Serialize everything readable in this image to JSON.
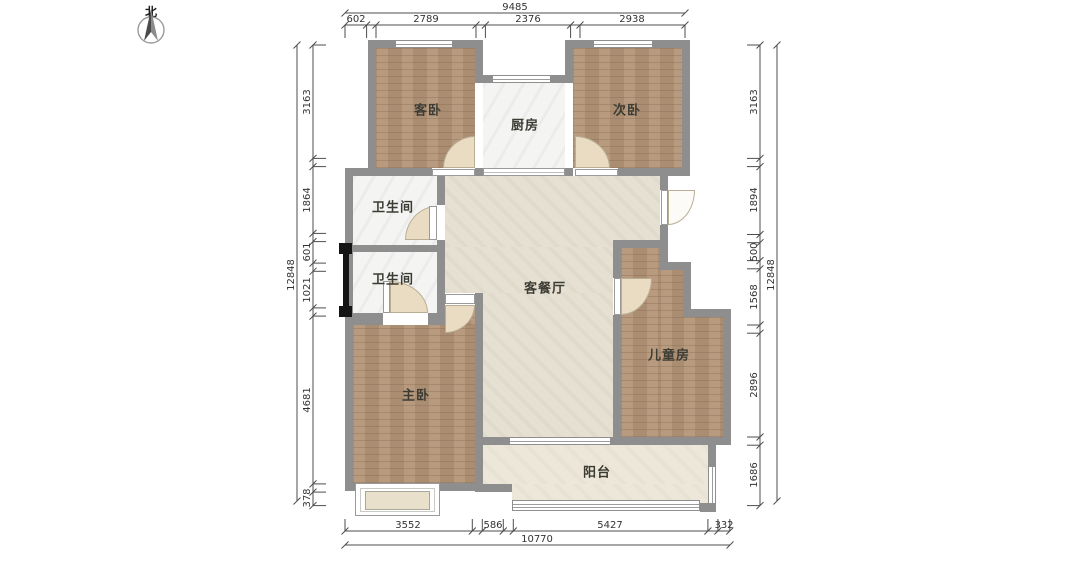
{
  "compass": {
    "label": "北"
  },
  "rooms": [
    {
      "name": "guest-bedroom",
      "label": "客卧"
    },
    {
      "name": "kitchen",
      "label": "厨房"
    },
    {
      "name": "second-bedroom",
      "label": "次卧"
    },
    {
      "name": "bathroom-upper",
      "label": "卫生间"
    },
    {
      "name": "bathroom-lower",
      "label": "卫生间"
    },
    {
      "name": "living-dining",
      "label": "客餐厅"
    },
    {
      "name": "master-bedroom",
      "label": "主卧"
    },
    {
      "name": "children-room",
      "label": "儿童房"
    },
    {
      "name": "balcony",
      "label": "阳台"
    }
  ],
  "dimensions": {
    "top": {
      "total": "9485",
      "segments": [
        "602",
        "2789",
        "2376",
        "2938"
      ]
    },
    "bottom": {
      "total": "10770",
      "segments": [
        "3552",
        "586",
        "5427",
        "332"
      ]
    },
    "left": {
      "total": "12848",
      "segments": [
        "3163",
        "1864",
        "601",
        "1021",
        "4681",
        "378"
      ]
    },
    "right": {
      "total": "12848",
      "segments": [
        "3163",
        "1894",
        "500",
        "1568",
        "2896",
        "1686"
      ]
    }
  },
  "colors": {
    "wall": "#8e8e8e",
    "wood_floor": "#b49678",
    "tile_floor": "#f4f4f2",
    "living_floor": "#e6e0d3",
    "balcony_floor": "#ece7d9",
    "entry_door": "#141414",
    "dim_line": "#4d4d4d"
  }
}
